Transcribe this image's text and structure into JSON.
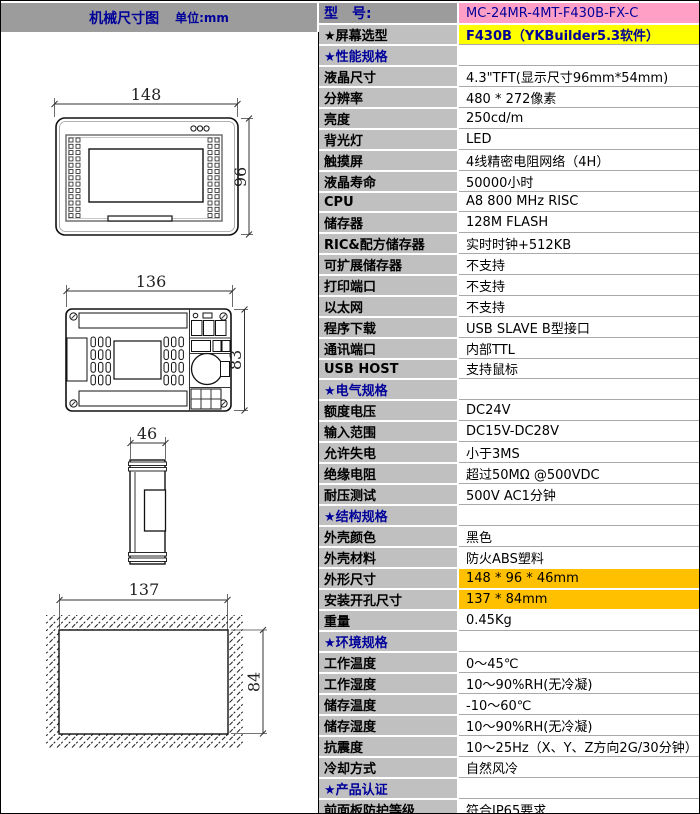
{
  "header": {
    "left_title": "机械尺寸图",
    "left_unit": "单位:mm"
  },
  "colors": {
    "model_pink": "#ff9fc6",
    "screen_yellow": "#ffff00",
    "dimension_orange": "#ffc000",
    "label_gray": "#c0c0c0",
    "header_gray": "#9c9c9c",
    "navy_text": "#00009a"
  },
  "drawings": {
    "front": {
      "width_dim": "148",
      "height_dim": "96"
    },
    "back": {
      "width_dim": "136",
      "height_dim": "83"
    },
    "side": {
      "width_dim": "46"
    },
    "cutout": {
      "width_dim": "137",
      "height_dim": "84"
    }
  },
  "spec": {
    "rows": [
      {
        "label": "型　号:",
        "value": "MC-24MR-4MT-F430B-FX-C"
      },
      {
        "label": "★屏幕选型",
        "value": "F430B（YKBuilder5.3软件）"
      },
      {
        "label": "★性能规格",
        "value": ""
      },
      {
        "label": "液晶尺寸",
        "value": "4.3\"TFT(显示尺寸96mm*54mm)"
      },
      {
        "label": "分辨率",
        "value": "480 * 272像素"
      },
      {
        "label": "亮度",
        "value": "250cd/m"
      },
      {
        "label": "背光灯",
        "value": "LED"
      },
      {
        "label": "触摸屏",
        "value": "4线精密电阻网络（4H）"
      },
      {
        "label": "液晶寿命",
        "value": "50000小时"
      },
      {
        "label": "CPU",
        "value": "A8 800 MHz RISC"
      },
      {
        "label": "储存器",
        "value": "128M FLASH"
      },
      {
        "label": "RIC&配方储存器",
        "value": "实时时钟+512KB"
      },
      {
        "label": "可扩展储存器",
        "value": "不支持"
      },
      {
        "label": "打印端口",
        "value": "不支持"
      },
      {
        "label": "以太网",
        "value": "不支持"
      },
      {
        "label": "程序下载",
        "value": "USB SLAVE B型接口"
      },
      {
        "label": "通讯端口",
        "value": "内部TTL"
      },
      {
        "label": "USB HOST",
        "value": "支持鼠标"
      },
      {
        "label": "★电气规格",
        "value": ""
      },
      {
        "label": "额度电压",
        "value": "DC24V"
      },
      {
        "label": "输入范围",
        "value": "DC15V-DC28V"
      },
      {
        "label": "允许失电",
        "value": "小于3MS"
      },
      {
        "label": "绝缘电阻",
        "value": "超过50MΩ @500VDC"
      },
      {
        "label": "耐压测试",
        "value": "500V AC1分钟"
      },
      {
        "label": "★结构规格",
        "value": ""
      },
      {
        "label": "外壳颜色",
        "value": "黑色"
      },
      {
        "label": "外壳材料",
        "value": "防火ABS塑料"
      },
      {
        "label": "外形尺寸",
        "value": "148 * 96 * 46mm"
      },
      {
        "label": "安装开孔尺寸",
        "value": "137 * 84mm"
      },
      {
        "label": "重量",
        "value": "0.45Kg"
      },
      {
        "label": "★环境规格",
        "value": ""
      },
      {
        "label": "工作温度",
        "value": "0～45℃"
      },
      {
        "label": "工作湿度",
        "value": "10～90%RH(无冷凝)"
      },
      {
        "label": "储存温度",
        "value": "-10～60℃"
      },
      {
        "label": "储存湿度",
        "value": "10～90%RH(无冷凝)"
      },
      {
        "label": "抗震度",
        "value": "10～25Hz（X、Y、Z方向2G/30分钟）"
      },
      {
        "label": "冷却方式",
        "value": "自然风冷"
      },
      {
        "label": "★产品认证",
        "value": ""
      },
      {
        "label": "前面板防护等级",
        "value": "符合IP65要求"
      },
      {
        "label": "CE认证",
        "value": "通过CE认证（EN61000-6-2:200S）"
      }
    ]
  }
}
